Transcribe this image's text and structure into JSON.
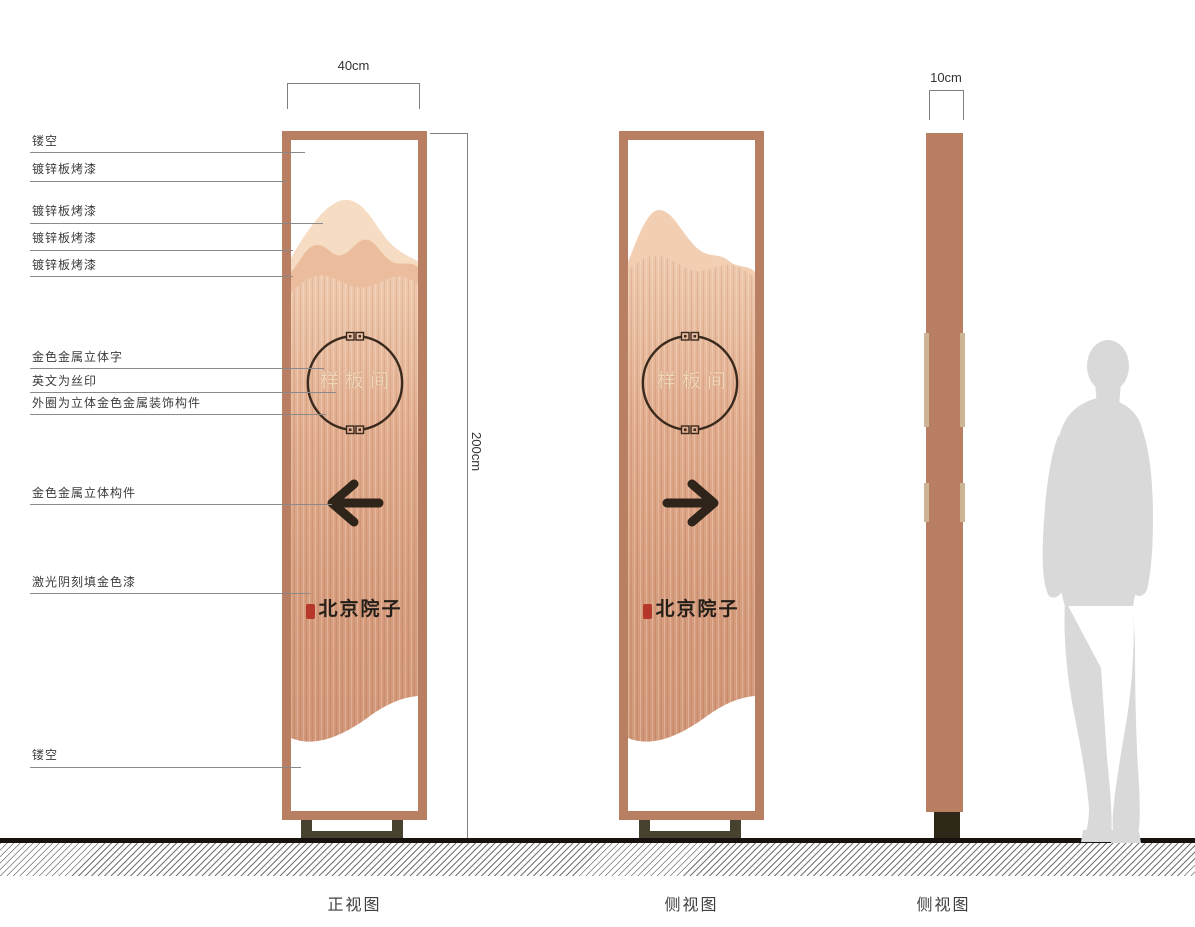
{
  "sheet": {
    "callouts": [
      {
        "label": "镂空"
      },
      {
        "label": "镀锌板烤漆"
      },
      {
        "label": "镀锌板烤漆"
      },
      {
        "label": "镀锌板烤漆"
      },
      {
        "label": "镀锌板烤漆"
      },
      {
        "label": "金色金属立体字"
      },
      {
        "label": "英文为丝印"
      },
      {
        "label": "外圈为立体金色金属装饰构件"
      },
      {
        "label": "金色金属立体构件"
      },
      {
        "label": "激光阴刻填金色漆"
      },
      {
        "label": "镂空"
      }
    ],
    "dimensions": {
      "front_width": "40cm",
      "height": "200cm",
      "side_width": "10cm"
    },
    "pylon": {
      "circle_text": "样板间",
      "brand_text": "北京院子"
    },
    "view_labels": {
      "front": "正视图",
      "side1": "侧视图",
      "side2": "侧视图"
    },
    "colors": {
      "frame_copper": "#b97f63",
      "panel_back_mountain": "#f5dcc3",
      "panel_mid_mountain": "#ecbd9d",
      "copper_gradient_top": "#eec7ab",
      "copper_gradient_bottom": "#cf9273",
      "emblem_stroke": "#3a2a1e",
      "arrow": "#2f2419",
      "seal_red": "#b5382a",
      "base_dark": "#474130",
      "edge_strip_tan": "#ccb494",
      "silhouette_gray": "#d9d9d9"
    }
  }
}
